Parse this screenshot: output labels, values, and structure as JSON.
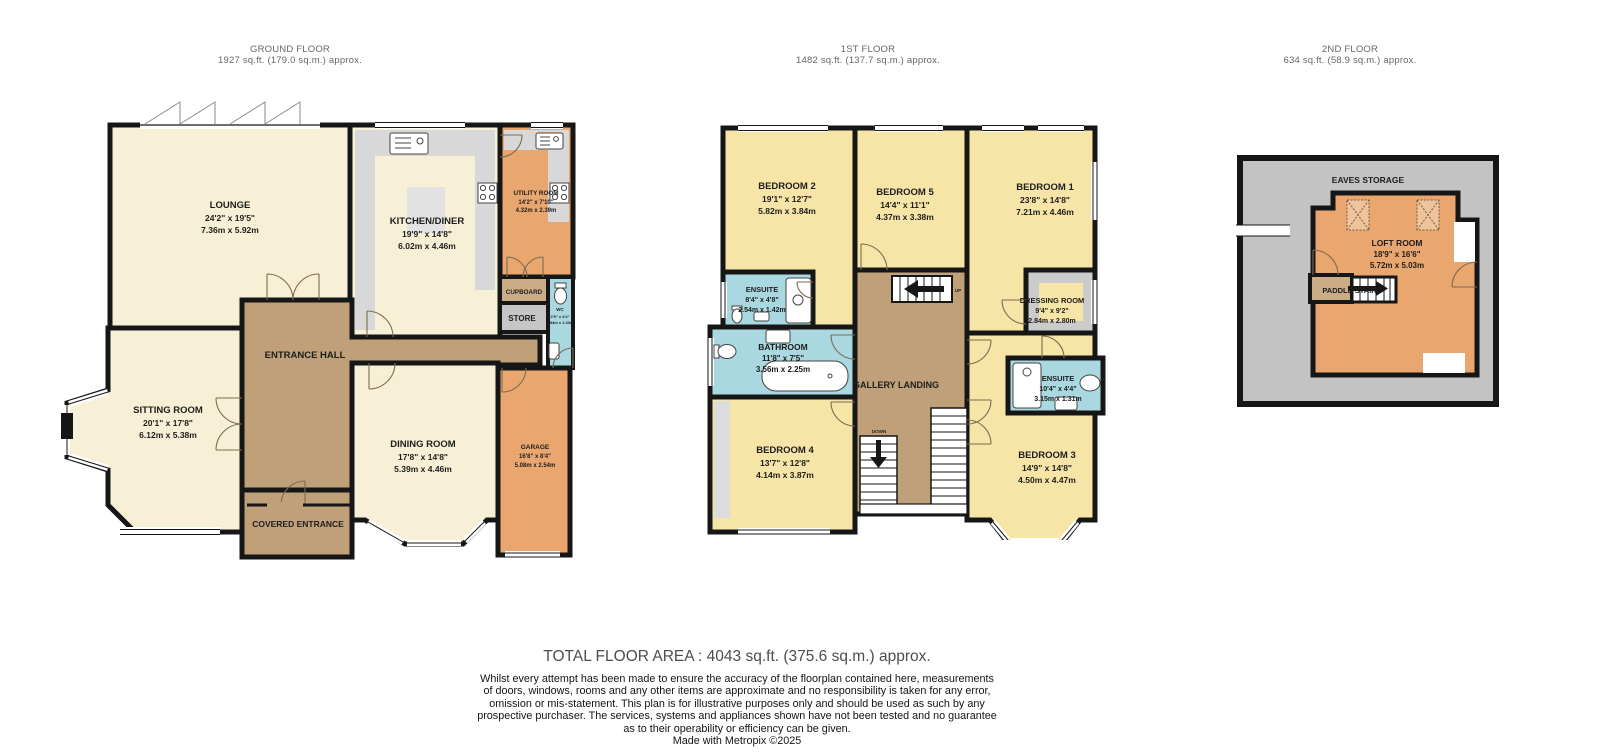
{
  "floors": {
    "ground": {
      "title": "GROUND FLOOR",
      "area": "1927 sq.ft. (179.0 sq.m.) approx."
    },
    "first": {
      "title": "1ST FLOOR",
      "area": "1482 sq.ft. (137.7 sq.m.) approx."
    },
    "second": {
      "title": "2ND FLOOR",
      "area": "634 sq.ft. (58.9 sq.m.) approx."
    }
  },
  "ground": {
    "lounge": {
      "name": "LOUNGE",
      "imp": "24'2\" x 19'5\"",
      "met": "7.36m x 5.92m"
    },
    "kitchen": {
      "name": "KITCHEN/DINER",
      "imp": "19'9\" x 14'8\"",
      "met": "6.02m x 4.46m"
    },
    "utility": {
      "name": "UTILITY ROOM",
      "imp": "14'2\" x 7'10\"",
      "met": "4.32m x 2.39m"
    },
    "cupboard": {
      "name": "CUPBOARD"
    },
    "store": {
      "name": "STORE"
    },
    "wc": {
      "name": "WC",
      "imp": "2'9\" x 4'4\"",
      "met": "0.84m x 1.33m"
    },
    "hall": {
      "name": "ENTRANCE HALL"
    },
    "sitting": {
      "name": "SITTING ROOM",
      "imp": "20'1\" x 17'8\"",
      "met": "6.12m x 5.38m"
    },
    "dining": {
      "name": "DINING ROOM",
      "imp": "17'8\" x 14'8\"",
      "met": "5.39m x 4.46m"
    },
    "garage": {
      "name": "GARAGE",
      "imp": "16'8\" x 8'4\"",
      "met": "5.08m x 2.54m"
    },
    "covered": {
      "name": "COVERED ENTRANCE"
    }
  },
  "first": {
    "bedroom2": {
      "name": "BEDROOM 2",
      "imp": "19'1\" x 12'7\"",
      "met": "5.82m x 3.84m"
    },
    "bedroom5": {
      "name": "BEDROOM 5",
      "imp": "14'4\" x 11'1\"",
      "met": "4.37m x 3.38m"
    },
    "bedroom1": {
      "name": "BEDROOM 1",
      "imp": "23'8\" x 14'8\"",
      "met": "7.21m x 4.46m"
    },
    "ensuite1": {
      "name": "ENSUITE",
      "imp": "8'4\" x 4'8\"",
      "met": "2.54m x 1.42m"
    },
    "bathroom": {
      "name": "BATHROOM",
      "imp": "11'8\" x 7'5\"",
      "met": "3.56m x 2.25m"
    },
    "landing": {
      "name": "GALLERY LANDING"
    },
    "dressing": {
      "name": "DRESSING ROOM",
      "imp": "9'4\" x 9'2\"",
      "met": "2.84m x 2.80m"
    },
    "ensuite2": {
      "name": "ENSUITE",
      "imp": "10'4\" x 4'4\"",
      "met": "3.15m x 1.31m"
    },
    "bedroom4": {
      "name": "BEDROOM 4",
      "imp": "13'7\" x 12'8\"",
      "met": "4.14m x 3.87m"
    },
    "bedroom3": {
      "name": "BEDROOM 3",
      "imp": "14'9\" x 14'8\"",
      "met": "4.50m x 4.47m"
    },
    "up": "UP",
    "down": "DOWN"
  },
  "second": {
    "eaves": {
      "name": "EAVES STORAGE"
    },
    "loft": {
      "name": "LOFT ROOM",
      "imp": "18'9\" x 16'6\"",
      "met": "5.72m x 5.03m"
    },
    "paddle": {
      "name": "PADDLE STAIRS"
    }
  },
  "footer": {
    "total": "TOTAL FLOOR AREA : 4043 sq.ft. (375.6 sq.m.) approx.",
    "disclaimer_lines": [
      "Whilst every attempt has been made to ensure the accuracy of the floorplan contained here, measurements",
      "of doors, windows, rooms and any other items are approximate and no responsibility is taken for any error,",
      "omission or mis-statement. This plan is for illustrative purposes only and should be used as such by any",
      "prospective purchaser. The services, systems and appliances shown have not been tested and no guarantee",
      "as to their operability or efficiency can be given."
    ],
    "made_with": "Made with Metropix ©2025"
  },
  "palette": {
    "room_cream": "#f8f0d6",
    "room_yellow": "#f6e5a6",
    "room_orange": "#e9a76f",
    "room_blue": "#a9d8e0",
    "hall_brown": "#bfa078",
    "light_brown": "#cbad85",
    "counter_gray": "#d8d8d8",
    "eaves_gray": "#c3c3c3",
    "wall_black": "#161616"
  }
}
